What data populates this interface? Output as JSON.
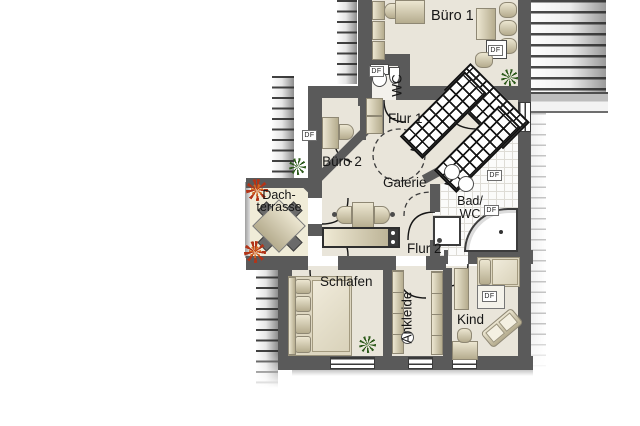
{
  "floorplan": {
    "rooms": {
      "buero1": "Büro 1",
      "wc": "WC",
      "flur1": "Flur 1",
      "buero2": "Büro 2",
      "galerie": "Galerie",
      "dachterrasse_line1": "Dach-",
      "dachterrasse_line2": "terrasse",
      "bad_line1": "Bad/",
      "bad_line2": "WC",
      "flur2": "Flur 2",
      "schlafen": "Schlafen",
      "ankleide": "Ankleide",
      "kind": "Kind"
    },
    "markers": {
      "roof_window": "DF"
    },
    "colors": {
      "wall": "#5a5a5a",
      "room_floor": "#e9e5da",
      "terrace_floor": "#f0ecd8",
      "furniture": "#d8d1b6",
      "bath_tile": "#fbfbfa",
      "plant_green": "#2d5a1b",
      "plant_red": "#b23418"
    }
  }
}
